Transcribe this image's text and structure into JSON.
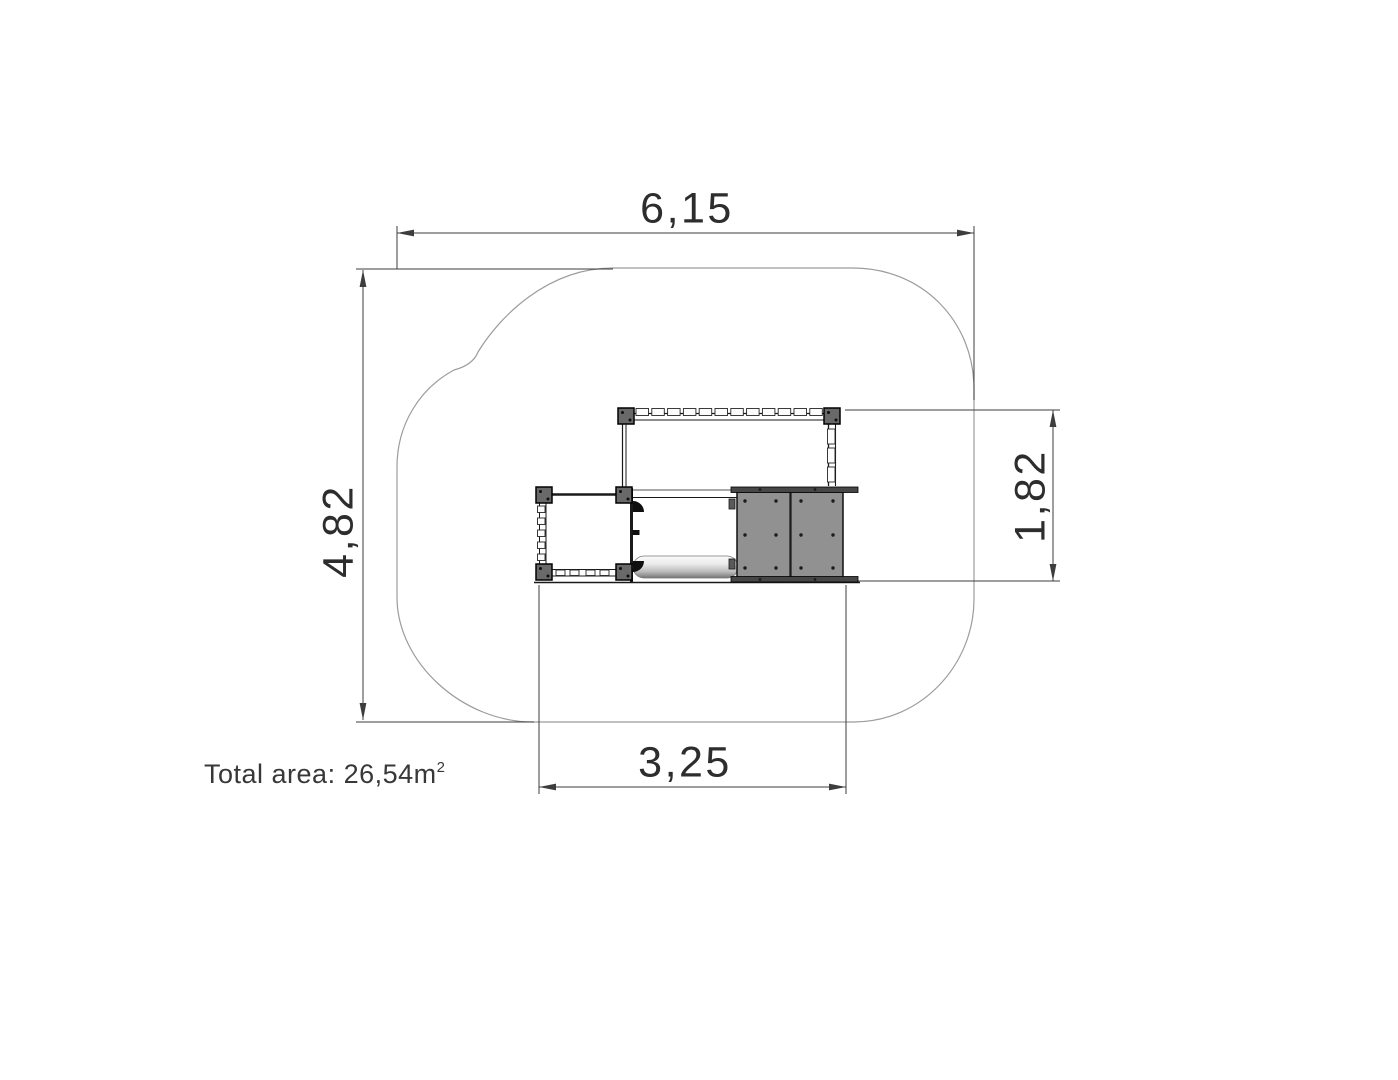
{
  "colors": {
    "background": "#ffffff",
    "dimension_line": "#3d3d3d",
    "label_text": "#2d2d2d",
    "zone_outline": "#9c9c9c",
    "structure_line": "#1a1a1a",
    "panel_fill": "#919191",
    "panel_cap_fill": "#474747",
    "post_fill": "#696969",
    "slat_fill": "#fdfdfd"
  },
  "dimensions": {
    "total_width": {
      "label": "6,15"
    },
    "total_height": {
      "label": "4,82"
    },
    "unit_width": {
      "label": "3,25"
    },
    "unit_height": {
      "label": "1,82"
    }
  },
  "notes": {
    "total_area_label": "Total area: ",
    "total_area_value": "26,54m",
    "total_area_exponent": "2"
  }
}
